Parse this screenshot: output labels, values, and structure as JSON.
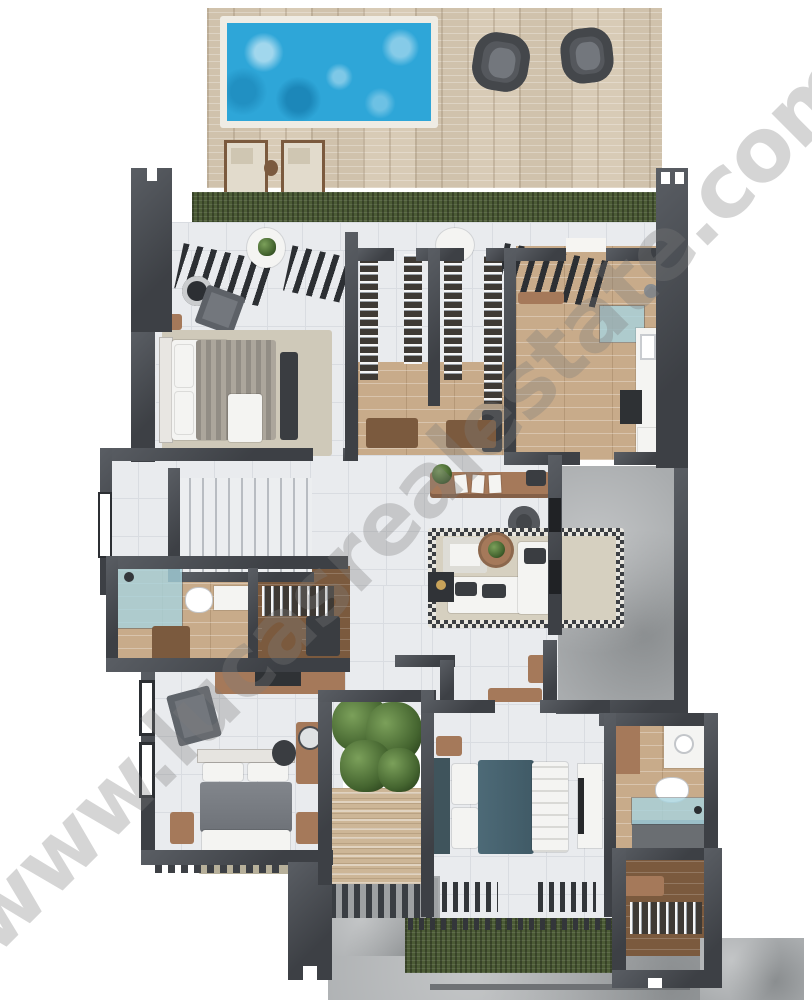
{
  "watermark": {
    "text": "www.lucasrealestate.com"
  },
  "palette": {
    "wall": "#3d4045",
    "wallHi": "#5a5e64",
    "tile": "#e9ebee",
    "tileLine": "#d9dce1",
    "deck": "#d8cbb6",
    "poolWater": "#2ea6d8",
    "poolEdge": "#efece4",
    "grass": "#4c5c36",
    "woodLight": "#c8ab8a",
    "woodMid": "#a5795a",
    "woodDark": "#7b5a3e",
    "concrete": "#a9acae",
    "concreteDark": "#6f7275",
    "travertine": "#cdb697",
    "glass": "#a8d4de",
    "teal": "#47626e",
    "furnDark": "#3a3d41",
    "furnGray": "#73777d",
    "sofa": "#f4f4f2",
    "rug": "#d6d0c0",
    "treeLight": "#7ba05a",
    "treeDark": "#44642f",
    "watermark": "rgba(125,125,125,0.32)"
  },
  "scene": {
    "type": "3d-rendered-floor-plan",
    "rooms": [
      "pool deck",
      "swimming pool",
      "roof terrace",
      "master bedroom",
      "walk-in closets",
      "kitchen",
      "stair hall",
      "living room",
      "bathroom",
      "closet",
      "bedroom 2",
      "interior garden",
      "bedroom 3",
      "bathroom 3",
      "closet 3",
      "concrete patio"
    ]
  }
}
